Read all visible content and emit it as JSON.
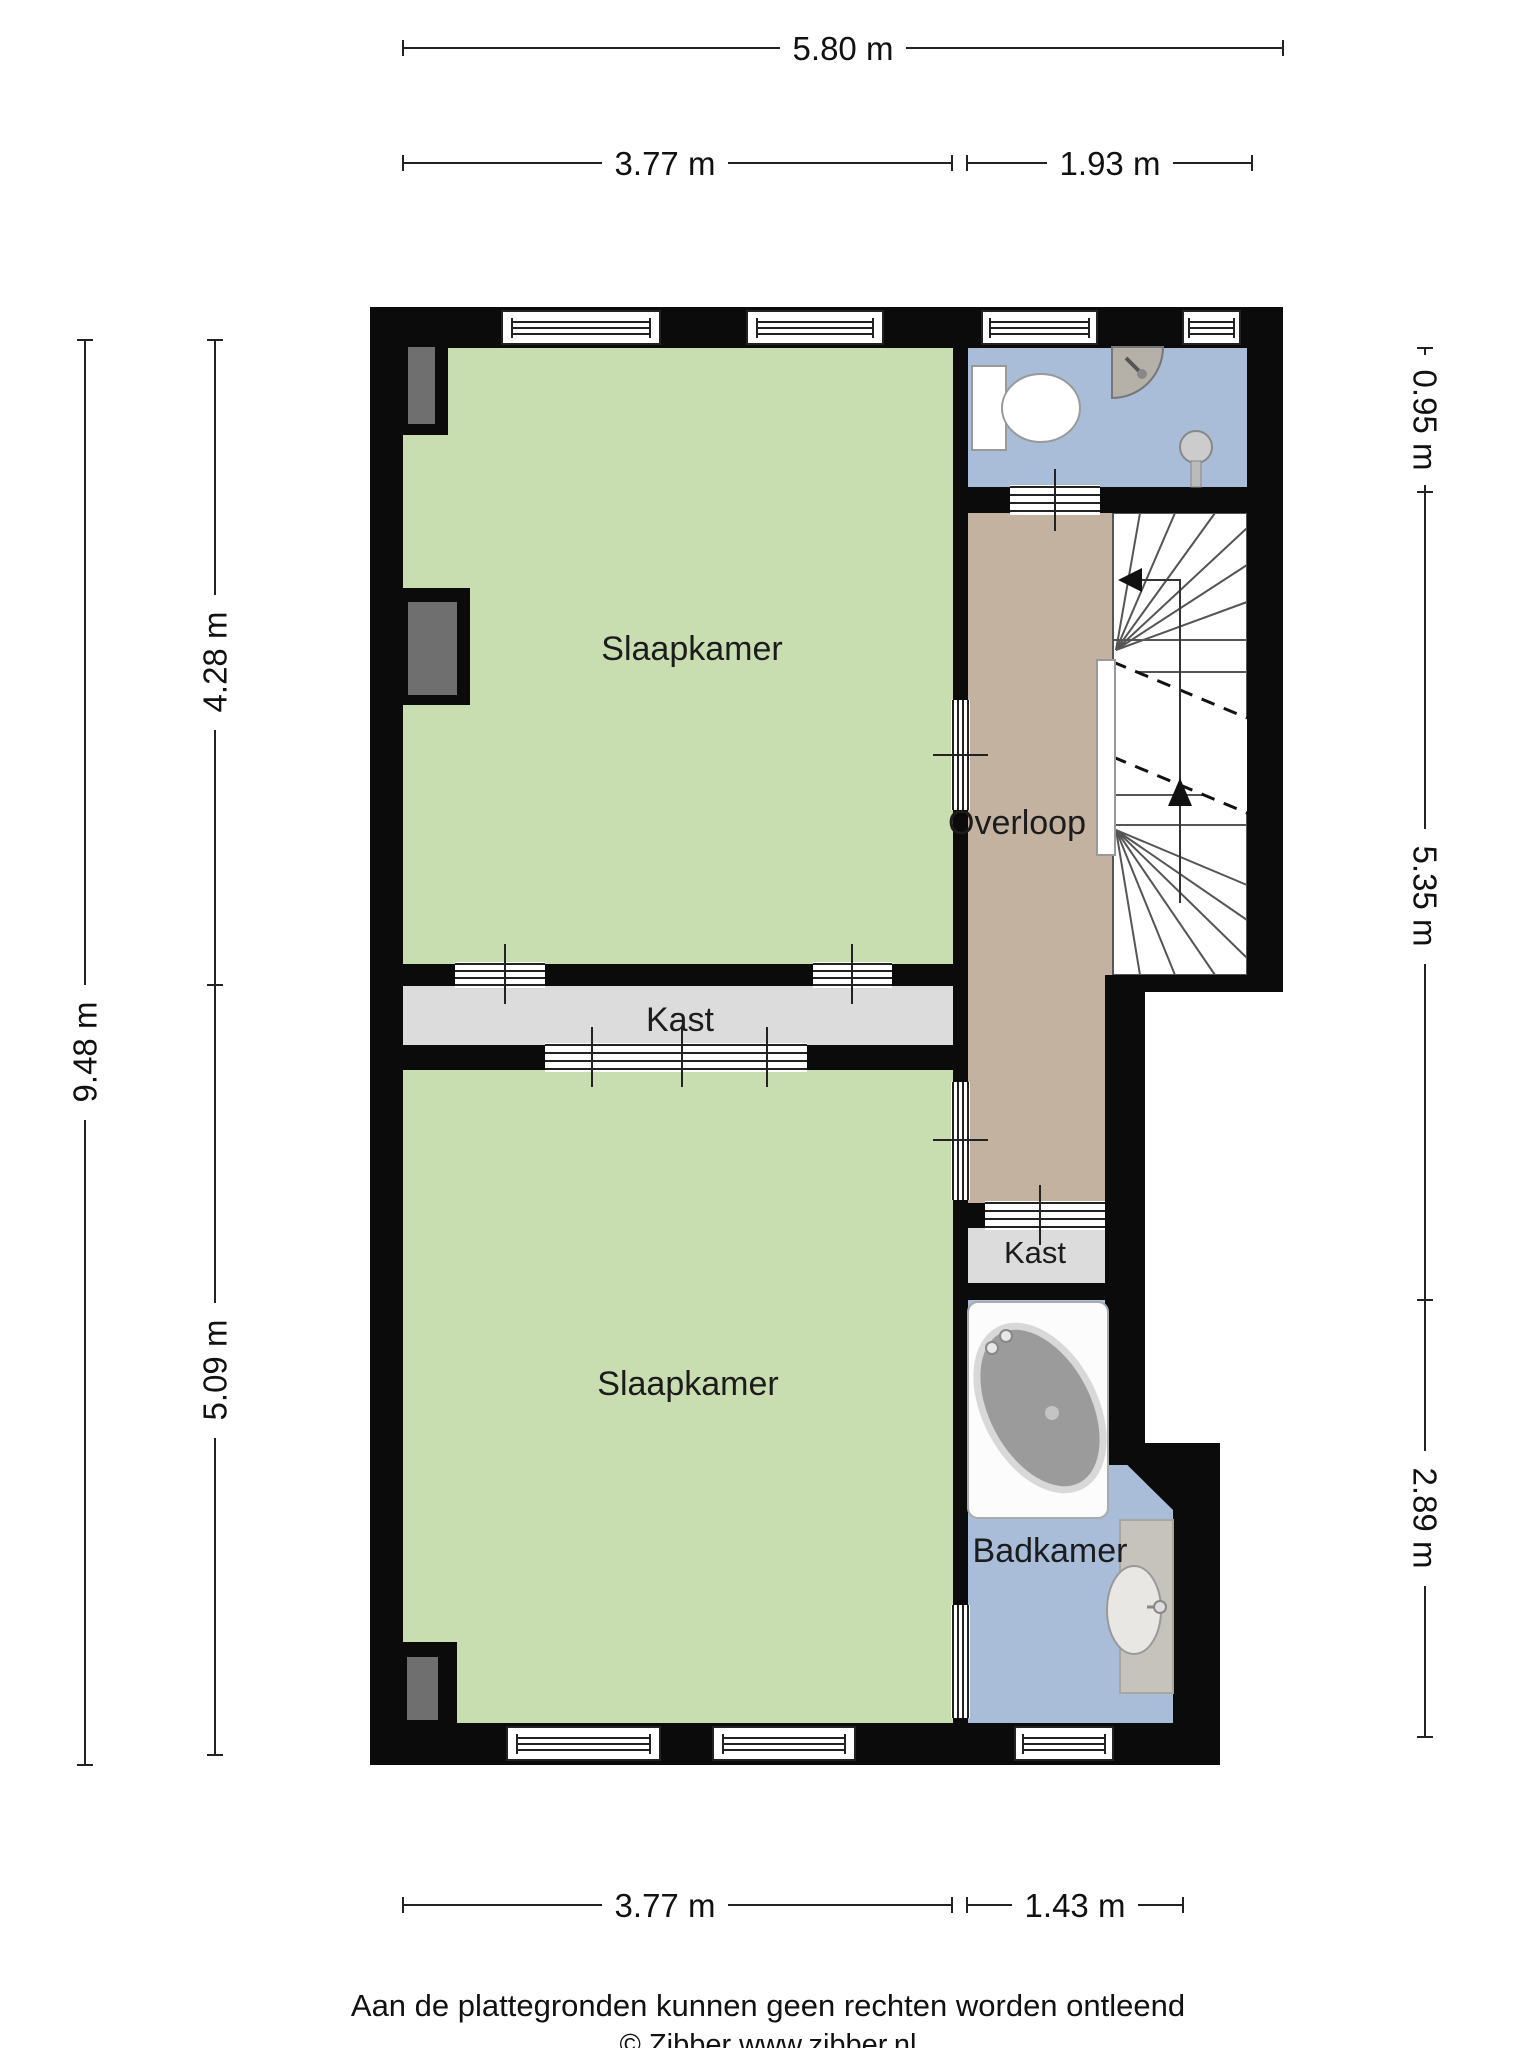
{
  "rooms": {
    "bedroom_top": {
      "label": "Slaapkamer"
    },
    "bedroom_bottom": {
      "label": "Slaapkamer"
    },
    "landing": {
      "label": "Overloop"
    },
    "closet_middle": {
      "label": "Kast"
    },
    "closet_small": {
      "label": "Kast"
    },
    "bathroom": {
      "label": "Badkamer"
    }
  },
  "dimensions": {
    "top_total": "5.80 m",
    "top_left": "3.77 m",
    "top_right": "1.93 m",
    "left_upper": "4.28 m",
    "left_total": "9.48 m",
    "left_lower": "5.09 m",
    "right_top": "0.95 m",
    "right_middle": "5.35 m",
    "right_bottom": "2.89 m",
    "bottom_left": "3.77 m",
    "bottom_right": "1.43 m"
  },
  "footer": {
    "disclaimer": "Aan de plattegronden kunnen geen rechten worden ontleend",
    "copyright": "© Zibber www.zibber.nl"
  },
  "colors": {
    "wall": "#0b0b0b",
    "bedroom": "#c8ddb0",
    "bathroom_floor": "#a9bdd9",
    "landing_floor": "#c4b2a0",
    "closet_floor": "#dcdcdc",
    "chimney": "#6f6f6f",
    "fixture": "#c9c9c9"
  }
}
